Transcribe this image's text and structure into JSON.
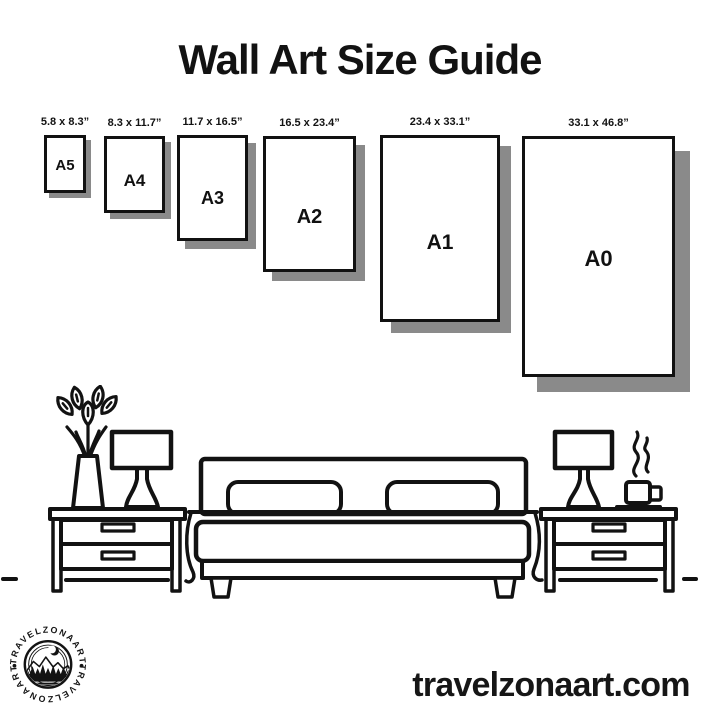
{
  "title": "Wall Art Size Guide",
  "sizes": [
    {
      "name": "A5",
      "dims": "5.8 x 8.3”"
    },
    {
      "name": "A4",
      "dims": "8.3 x 11.7”"
    },
    {
      "name": "A3",
      "dims": "11.7 x 16.5”"
    },
    {
      "name": "A2",
      "dims": "16.5 x 23.4”"
    },
    {
      "name": "A1",
      "dims": "23.4 x 33.1”"
    },
    {
      "name": "A0",
      "dims": "33.1 x 46.8”"
    }
  ],
  "logo": {
    "brand": "TRAVELZONAART"
  },
  "footer": {
    "website": "travelzonaart.com"
  },
  "colors": {
    "ink": "#121212",
    "shadow": "#8a8a8a",
    "background": "#ffffff"
  }
}
